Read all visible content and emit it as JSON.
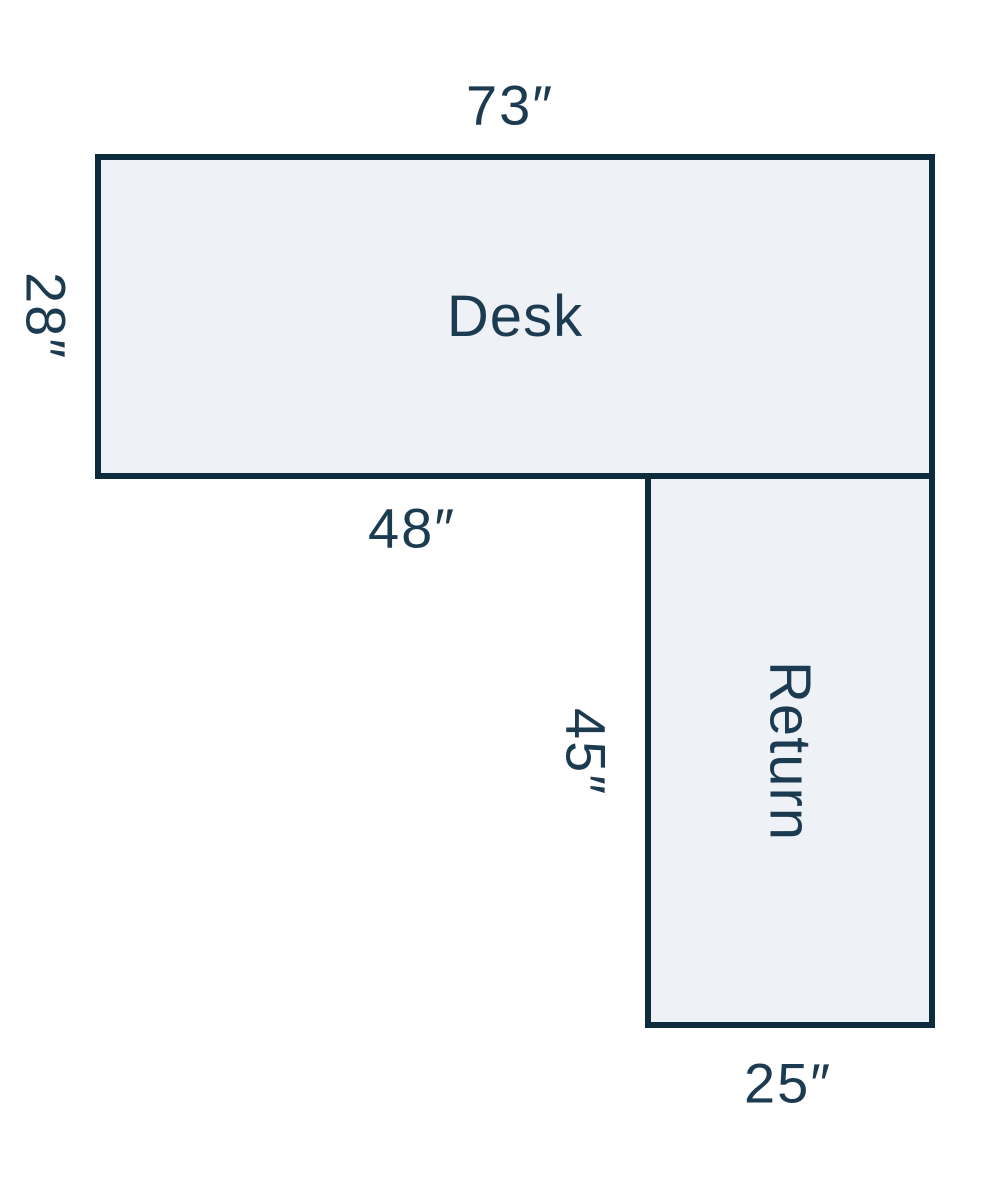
{
  "figure": {
    "desk": {
      "label": "Desk",
      "top_dimension": "73″",
      "left_dimension": "28″",
      "bottom_dimension": "48″"
    },
    "return": {
      "label": "Return",
      "left_dimension": "45″",
      "bottom_dimension": "25″"
    }
  },
  "colors": {
    "background": "#ffffff",
    "shape_fill": "#eef2f7",
    "shape_border": "#0c2b3d",
    "label_text": "#1c3a50"
  }
}
